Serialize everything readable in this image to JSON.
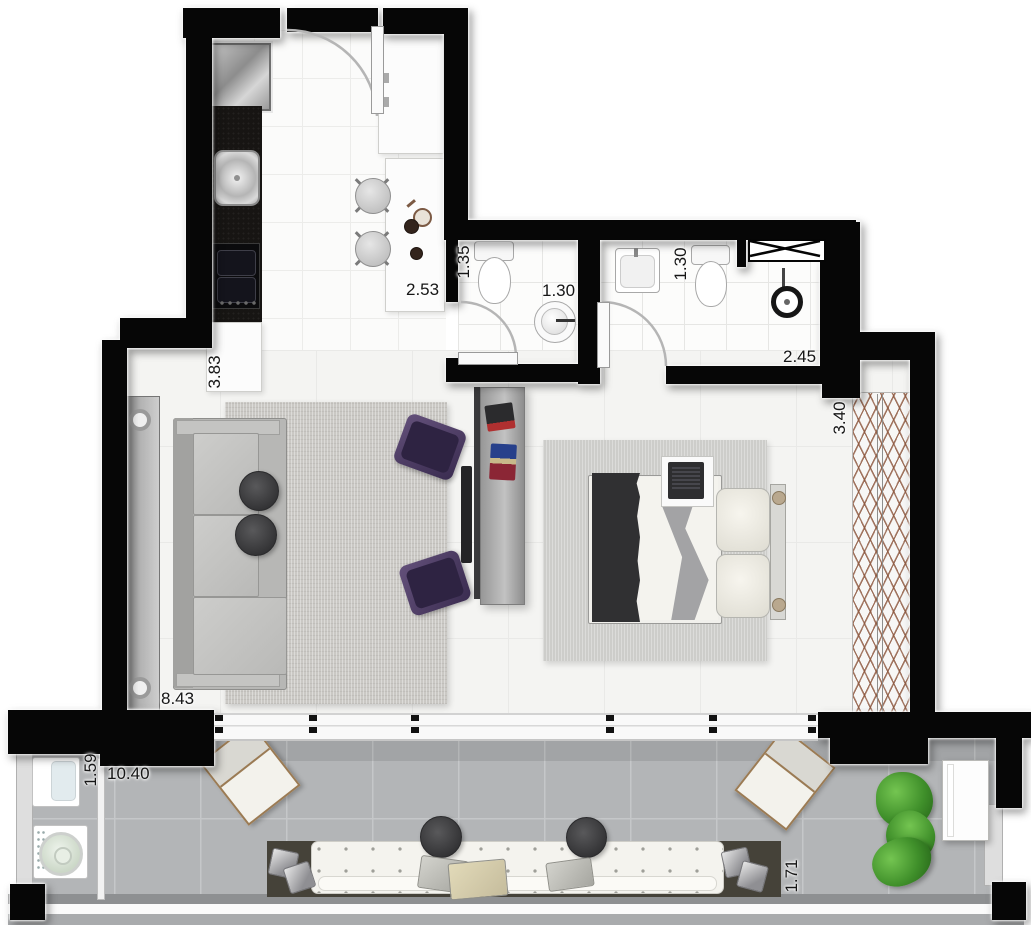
{
  "floor_plan": {
    "type": "studio-apartment-floor-plan",
    "dimension_labels": {
      "kitchen_width": "2.53",
      "kitchen_length": "3.83",
      "bath1_depth": "1.35",
      "bath1_width": "1.30",
      "bath2_depth": "1.30",
      "bath2_width": "2.45",
      "bedroom_width": "3.40",
      "living_span": "8.43",
      "laundry_width": "1.59",
      "balcony_span": "10.40",
      "balcony_depth": "1.71"
    },
    "colors": {
      "wall": "#060606",
      "interior_floor": "#f4f4f2",
      "wet_area_floor": "#fbfbfa",
      "balcony_floor": "#b3b5b7",
      "rug": "#cac8c4",
      "armchair_purple": "#4e3d5e",
      "plant_green": "#3f8f2a",
      "wood_deck": "#454239",
      "kitchen_counter_black": "#171513"
    }
  }
}
